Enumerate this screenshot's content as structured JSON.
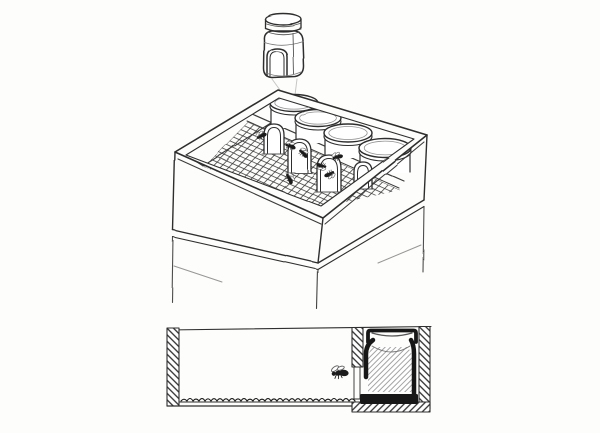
{
  "meta": {
    "kind": "hand-drawn pencil sketch, no text",
    "subject": "jar-super beehive: hive box holding four inverted jars with arched bee entrances over a mesh floor; one jar lifted above; stacked hive boxes below; cross-section diagram of jar compartment with bee"
  },
  "colors": {
    "paper": "#fdfdfb",
    "ink": "#2f2f2f",
    "ink_soft": "#555555",
    "pencil": "#8f8f8f",
    "guide": "#c6c6c6",
    "black": "#171717",
    "white": "#ffffff"
  },
  "top_illustration": {
    "jar_count": 4,
    "entrance_count": 4,
    "bee_count": 7,
    "jars": [
      {
        "cx": 294,
        "cy": 103,
        "rx": 24,
        "ry": 8.5
      },
      {
        "cx": 318,
        "cy": 118,
        "rx": 23,
        "ry": 8.5
      },
      {
        "cx": 348,
        "cy": 133,
        "rx": 24,
        "ry": 9
      },
      {
        "cx": 385,
        "cy": 148,
        "rx": 26,
        "ry": 9.5
      }
    ],
    "entrances": [
      {
        "x": 264,
        "y": 124,
        "w": 20,
        "h": 30
      },
      {
        "x": 288,
        "y": 139,
        "w": 23,
        "h": 34
      },
      {
        "x": 317,
        "y": 155,
        "w": 24,
        "h": 37
      },
      {
        "x": 354,
        "y": 162,
        "w": 18,
        "h": 27
      }
    ],
    "bees": [
      {
        "x": 261,
        "y": 136,
        "rot": -30,
        "s": 1
      },
      {
        "x": 290,
        "y": 146,
        "rot": 15,
        "s": 1
      },
      {
        "x": 303,
        "y": 153,
        "rot": 40,
        "s": 1
      },
      {
        "x": 337,
        "y": 157,
        "rot": -20,
        "s": 1
      },
      {
        "x": 322,
        "y": 166,
        "rot": 190,
        "s": 0.95
      },
      {
        "x": 330,
        "y": 174,
        "rot": 150,
        "s": 1
      },
      {
        "x": 289,
        "y": 178,
        "rot": 60,
        "s": 1
      }
    ],
    "mesh": {
      "polygon": [
        [
          204,
          167
        ],
        [
          248,
          122
        ],
        [
          400,
          190
        ],
        [
          318,
          208
        ]
      ],
      "lines_a": 13,
      "lines_b": 27
    }
  },
  "cross_section": {
    "bee_count": 1,
    "bees": [
      {
        "x": 339,
        "y": 373,
        "rot": -8,
        "s": 1.6
      }
    ],
    "wavy_baseline": {
      "x1": 181,
      "x2": 350,
      "y": 401,
      "step": 6
    }
  }
}
